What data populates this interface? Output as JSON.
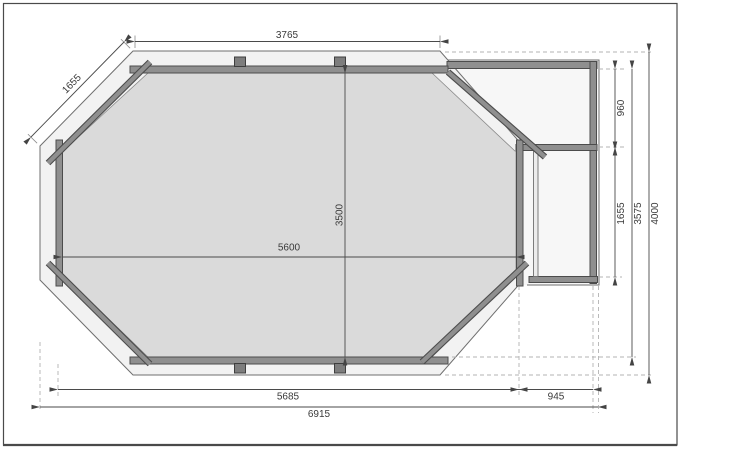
{
  "drawing": {
    "type": "octagonal-pool-floor-plan",
    "dimensions": {
      "top_width": "3765",
      "diagonal_side": "1655",
      "inner_width": "5600",
      "inner_height": "3500",
      "annex_upper_height": "960",
      "annex_lower_height": "1655",
      "right_height": "3575",
      "total_height": "4000",
      "bottom_width": "5685",
      "annex_width": "945",
      "total_width": "6915"
    },
    "colors": {
      "wall_fill": "#8f8f8f",
      "wall_stroke": "#4c4c4c",
      "deck_fill": "#f2f2f2",
      "deck_stroke": "#6f6f6f",
      "interior_fill": "#dadada",
      "interior_stroke": "#8a8a8a",
      "annex_fill": "#f7f7f7",
      "block_fill": "#7d7d7d",
      "dim_color": "#4a4a4a",
      "dashed_color": "#b3b3b3",
      "text_color": "#3a3a3a",
      "frame_color": "#4a4a4a"
    }
  }
}
